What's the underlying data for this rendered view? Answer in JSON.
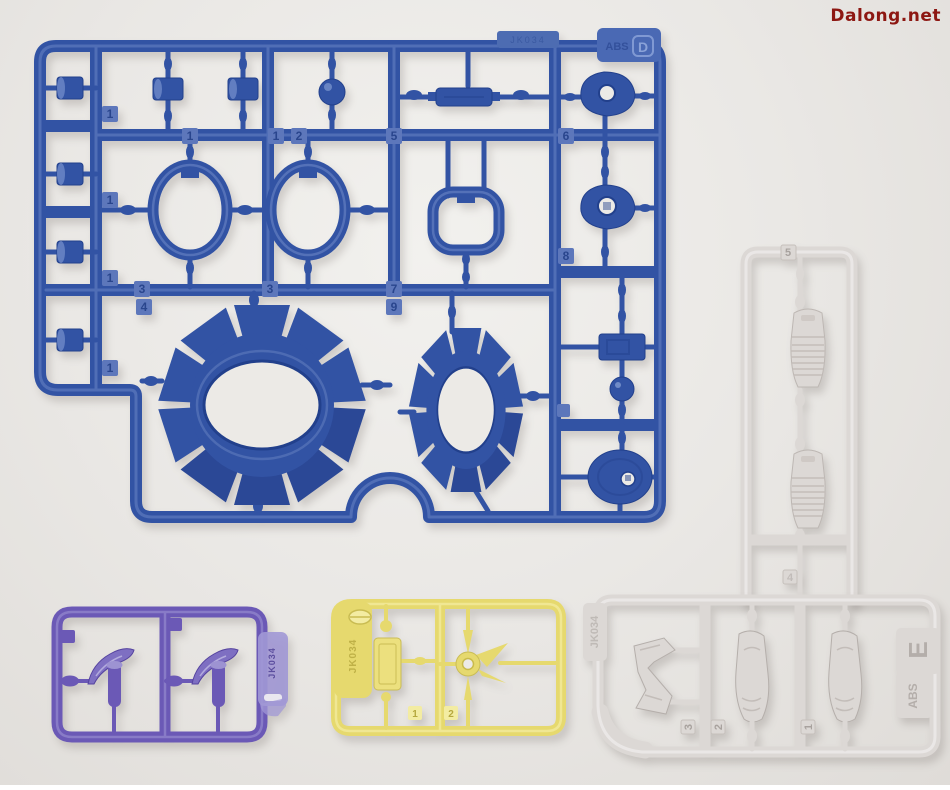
{
  "watermark": {
    "text": "Dalong.net"
  },
  "colors": {
    "blue_base": "#3253a4",
    "blue_dark": "#22408c",
    "blue_light": "#7690cb",
    "blue_tag": "#5d77bb",
    "blue_text": "#203d85",
    "white_base": "#dcd8d5",
    "white_light": "#f0eeec",
    "white_text": "#a8a29e",
    "purple_base": "#6b59b6",
    "purple_light": "#a198d5",
    "purple_text": "#4a3b92",
    "yellow_base": "#e6d96e",
    "yellow_light": "#f3eca2",
    "yellow_text": "#b6a83e",
    "hole": "#eceae6",
    "watermark": "#8d1712"
  },
  "runner_blue": {
    "letter": "D",
    "material": "ABS",
    "mold_code": "JK034",
    "tags": {
      "left1": "1",
      "left2": "1",
      "left3": "1",
      "left4": "1",
      "top_a": "1",
      "top_b": "1",
      "top_c": "2",
      "top_d": "5",
      "mid_a": "3",
      "mid_b": "3",
      "mid_c": "4",
      "mid_d": "7",
      "mid_e": "9",
      "right_a": "6",
      "right_b": "8"
    }
  },
  "runner_white_tall": {
    "tags": {
      "top": "5",
      "bottom": "4"
    }
  },
  "runner_white_bottom": {
    "letter": "E",
    "material": "ABS",
    "mold_code": "JK034",
    "tags": {
      "a": "3",
      "b": "2",
      "c": "1"
    }
  },
  "runner_purple": {
    "mold_code": "JK034"
  },
  "runner_yellow": {
    "mold_code": "JK034",
    "tags": {
      "a": "1",
      "b": "2"
    }
  }
}
